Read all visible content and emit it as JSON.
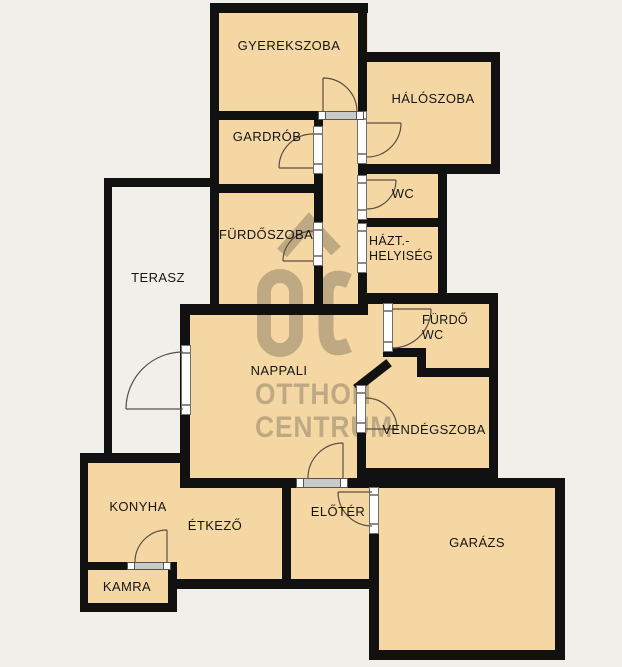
{
  "floorplan": {
    "rooms": {
      "gyerekszoba": "GYEREKSZOBA",
      "haloszoba": "HÁLÓSZOBA",
      "gardrob": "GARDRÓB",
      "wc": "WC",
      "furdoszoba": "FÜRDŐSZOBA",
      "hazt_line1": "HÁZT.-",
      "hazt_line2": "HELYISÉG",
      "terasz": "TERASZ",
      "nappali": "NAPPALI",
      "furdo_wc_line1": "FÜRDŐ",
      "furdo_wc_line2": "WC",
      "vendegszoba": "VENDÉGSZOBA",
      "konyha": "KONYHA",
      "etkezo": "ÉTKEZŐ",
      "eloter": "ELŐTÉR",
      "kamra": "KAMRA",
      "garazs": "GARÁZS"
    },
    "watermark": {
      "line1": "OTTHON",
      "line2": "CENTRUM"
    },
    "colors": {
      "room_fill": "#f5d7a4",
      "background": "#f1efea",
      "wall": "#111111",
      "watermark": "#8a7c64"
    }
  }
}
